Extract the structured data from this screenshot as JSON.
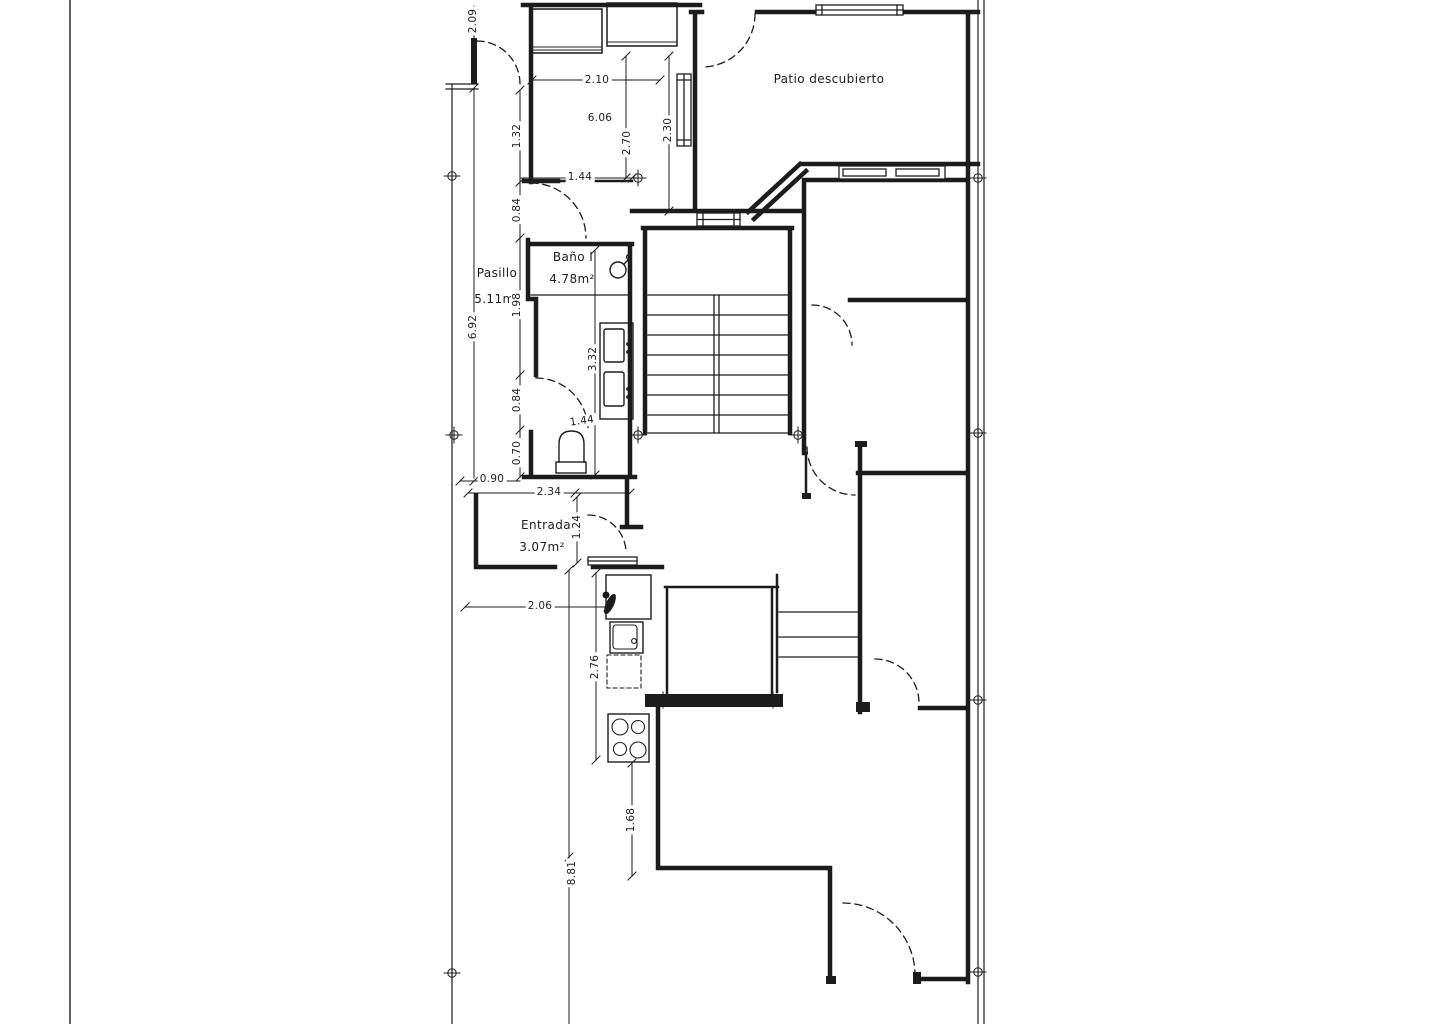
{
  "drawing": {
    "type": "architectural-floor-plan",
    "rooms": {
      "patio": {
        "label": "Patio descubierto"
      },
      "bano": {
        "label": "Baño I",
        "area": "4.78m²"
      },
      "pasillo": {
        "label": "Pasillo",
        "area": "5.11m²"
      },
      "entrada": {
        "label": "Entrada",
        "area": "3.07m²"
      }
    },
    "dims": {
      "d_209": "2.09",
      "d_210": "2.10",
      "d_606": "6.06",
      "d_270": "2.70",
      "d_230": "2.30",
      "d_132": "1.32",
      "d_144a": "1.44",
      "d_084a": "0.84",
      "d_198": "1.98",
      "d_692": "6.92",
      "d_332": "3.32",
      "d_084b": "0.84",
      "d_144b": "1.44",
      "d_070": "0.70",
      "d_090": "0.90",
      "d_234": "2.34",
      "d_124": "1.24",
      "d_206": "2.06",
      "d_276": "2.76",
      "d_168": "1.68",
      "d_881": "8.81"
    },
    "colors": {
      "line": "#1c1c1c",
      "background": "#ffffff"
    }
  }
}
